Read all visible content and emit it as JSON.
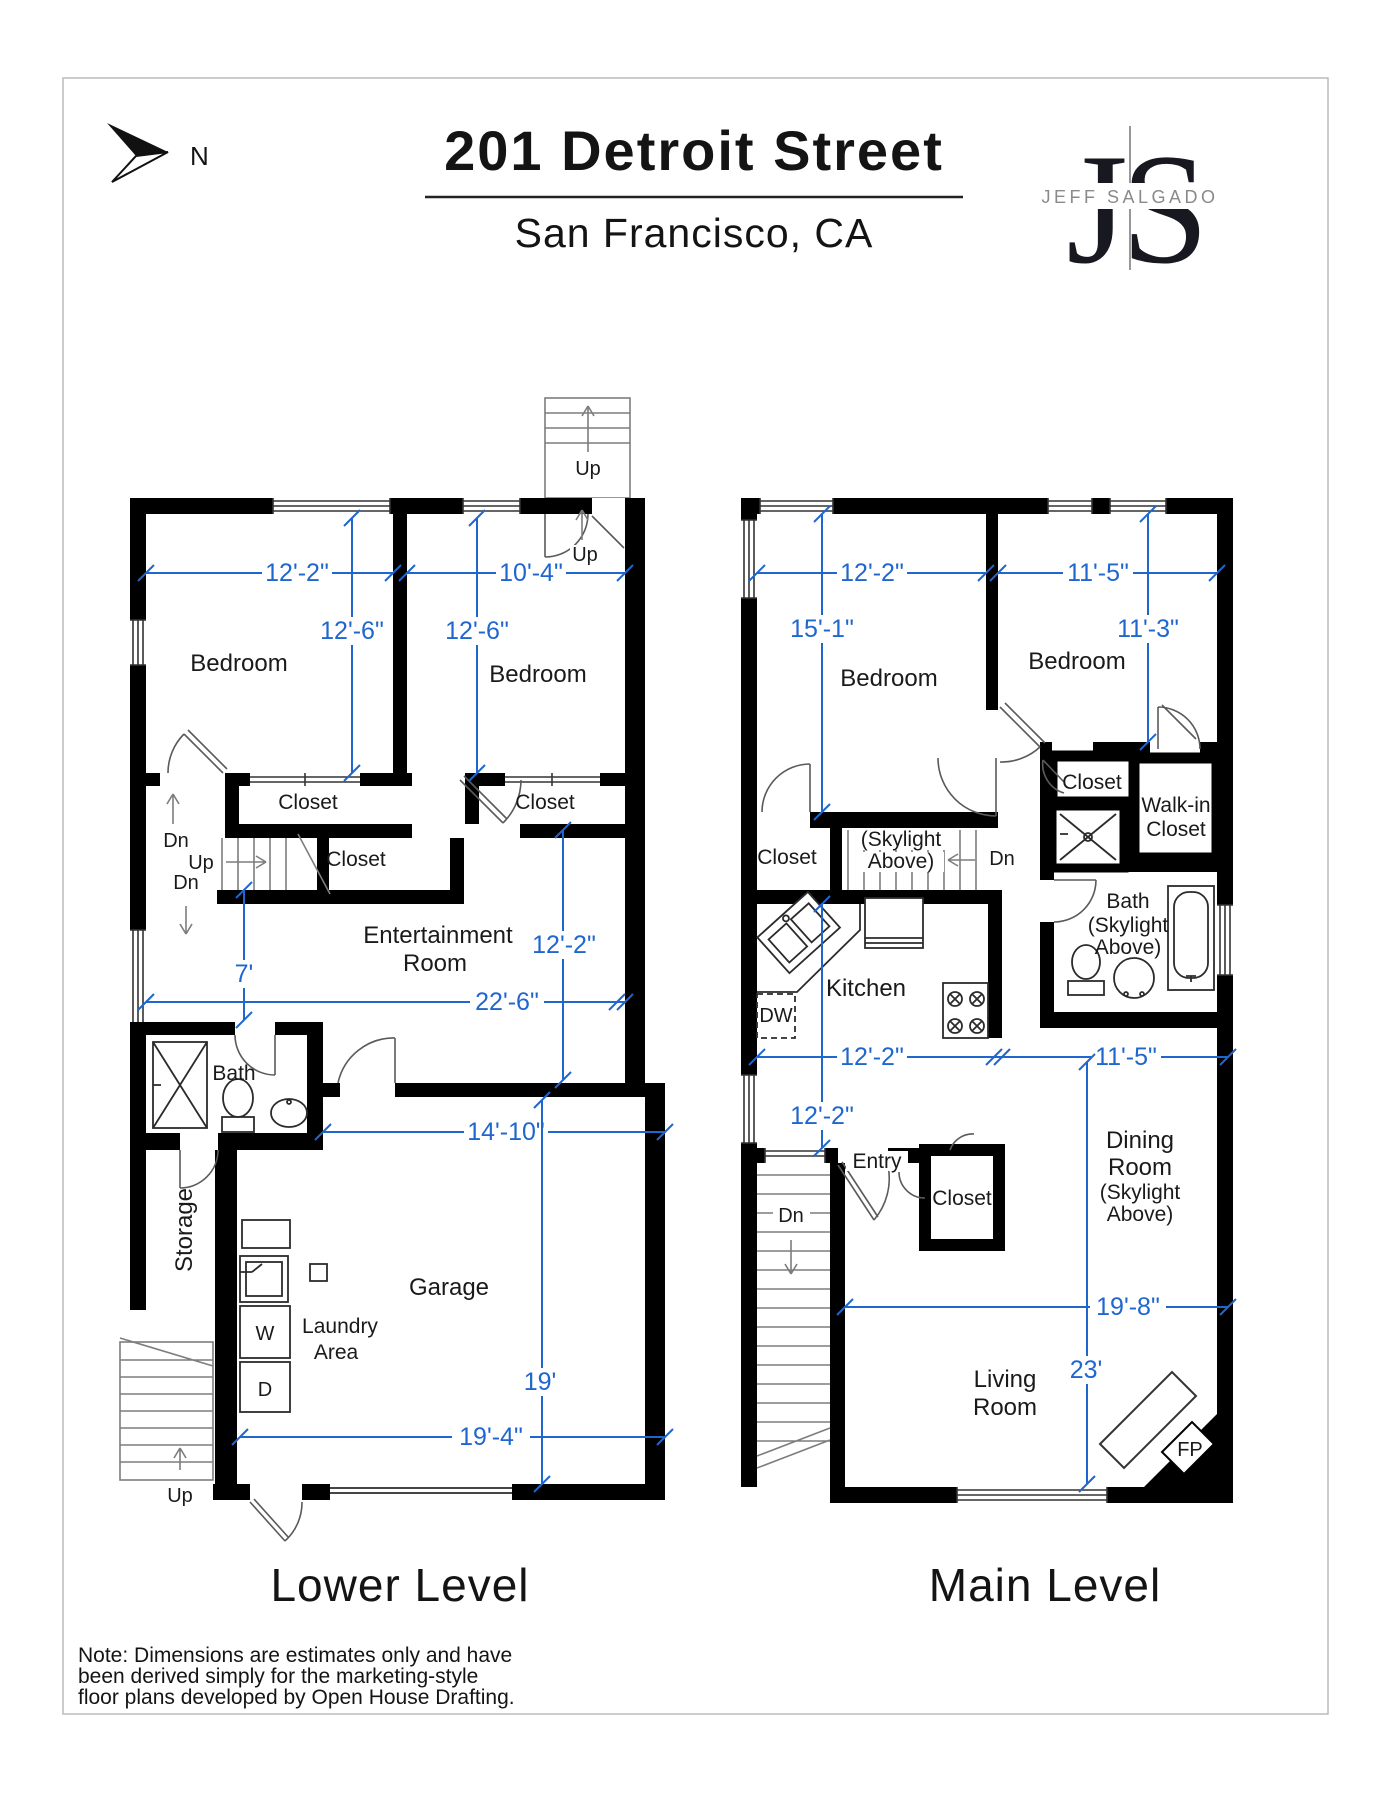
{
  "header": {
    "compass": "N",
    "title": "201 Detroit Street",
    "subtitle": "San Francisco, CA",
    "logo_j": "J",
    "logo_s": "S",
    "logo_name": "JEFF SALGADO"
  },
  "lower": {
    "title": "Lower Level",
    "rooms": {
      "bedroom_left": "Bedroom",
      "bedroom_right": "Bedroom",
      "closet_left": "Closet",
      "closet_right": "Closet",
      "closet_hall": "Closet",
      "entertainment_line1": "Entertainment",
      "entertainment_line2": "Room",
      "bath": "Bath",
      "storage": "Storage",
      "garage": "Garage",
      "laundry_line1": "Laundry",
      "laundry_line2": "Area",
      "washer": "W",
      "dryer": "D"
    },
    "stairs": {
      "top_up": "Up",
      "inner_up": "Up",
      "hall_dn1": "Dn",
      "hall_up": "Up",
      "hall_dn2": "Dn",
      "bottom_up": "Up"
    },
    "dims": {
      "bed_left_w": "12'-2\"",
      "bed_right_w": "10'-4\"",
      "bed_left_h": "12'-6\"",
      "bed_right_h": "12'-6\"",
      "hall_w": "7'",
      "ent_w": "22'-6\"",
      "ent_h": "12'-2\"",
      "garage_upper_w": "14'-10\"",
      "garage_h": "19'",
      "garage_w": "19'-4\""
    }
  },
  "main": {
    "title": "Main Level",
    "rooms": {
      "bedroom_left": "Bedroom",
      "bedroom_right": "Bedroom",
      "closet_small": "Closet",
      "walkin_line1": "Walk-in",
      "walkin_line2": "Closet",
      "closet_hall": "Closet",
      "stairs_note_line1": "(Skylight",
      "stairs_note_line2": "Above)",
      "bath": "Bath",
      "bath_note_line1": "(Skylight",
      "bath_note_line2": "Above)",
      "kitchen": "Kitchen",
      "dishwasher": "DW",
      "entry": "Entry",
      "closet_entry": "Closet",
      "dining_line1": "Dining",
      "dining_line2": "Room",
      "dining_note_line1": "(Skylight",
      "dining_note_line2": "Above)",
      "living_line1": "Living",
      "living_line2": "Room",
      "fireplace": "FP"
    },
    "stairs": {
      "upper_dn": "Dn",
      "entry_dn": "Dn"
    },
    "dims": {
      "bed_left_w": "12'-2\"",
      "bed_right_w": "11'-5\"",
      "bed_left_h": "15'-1\"",
      "bed_right_h": "11'-3\"",
      "kitchen_w": "12'-2\"",
      "dining_w": "11'-5\"",
      "kitchen_h": "12'-2\"",
      "living_w": "19'-8\"",
      "living_h": "23'"
    }
  },
  "footer": {
    "note_line1": "Note: Dimensions are estimates only and have",
    "note_line2": "been derived simply for the marketing-style",
    "note_line3": "floor plans developed by Open House Drafting."
  },
  "colors": {
    "dimension_blue": "#1f66cf",
    "wall_black": "#000000"
  }
}
